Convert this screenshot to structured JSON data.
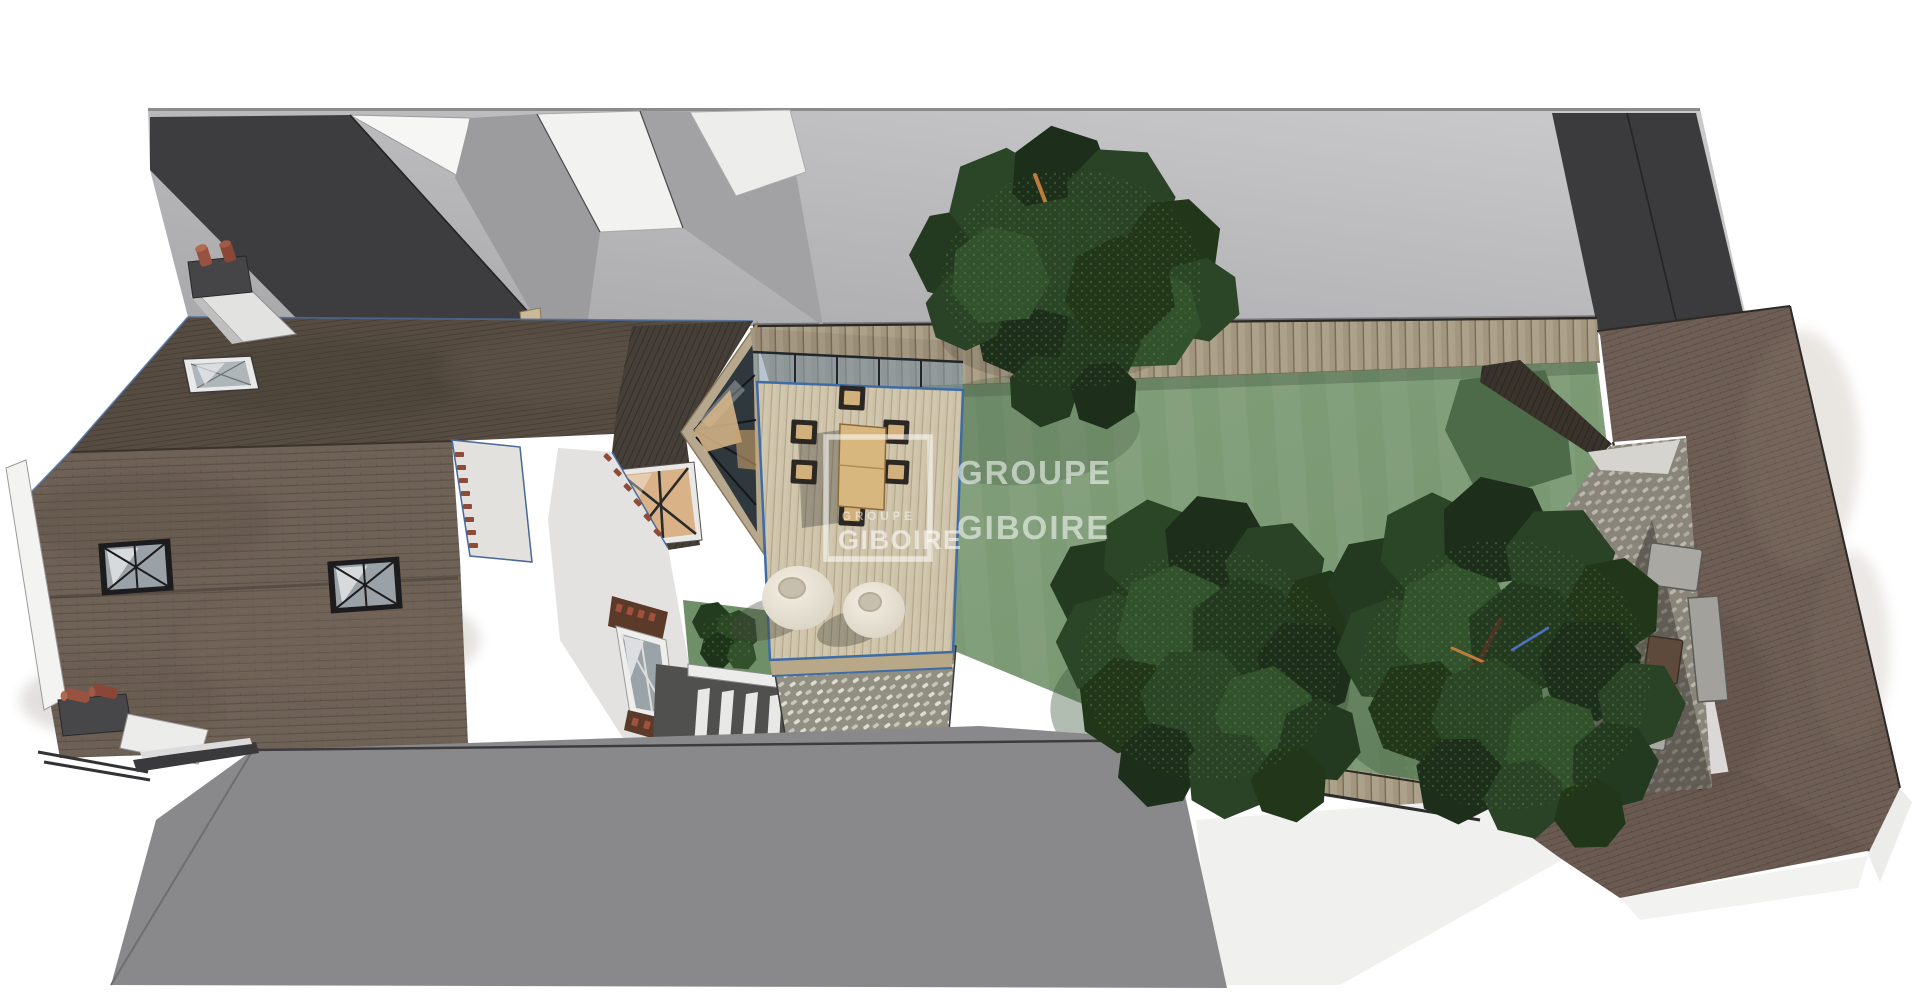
{
  "watermark": {
    "brand_line1": "GROUPE",
    "brand_line2": "GIBOIRE",
    "logo_text_small": "GROUPE",
    "logo_text_large": "GIBOIRE"
  },
  "colors": {
    "background": "#ffffff",
    "ground": "#b5b4b6",
    "building_dark": "#3d3d3f",
    "building_gray": "#9c9c9e",
    "building_white": "#f5f5f4",
    "roof_front": "#6e6156",
    "roof_back": "#564c42",
    "roof_right": "#6e5e55",
    "wall_dark": "#3b3b3d",
    "fence_wood": "#a3967e",
    "lawn": "#7e9c77",
    "foliage": "#243a20",
    "deck_wood": "#cec3a9",
    "wall_white": "#f1efec",
    "terracotta": "#8d4b38",
    "pebble_path": "#918e82",
    "neighbor_roof": "#8f8f91",
    "bay_glass": "#2e383d",
    "canopy_glass": "#7d96aa",
    "furniture_tan": "#d8b77e",
    "pouf_cream": "#e6e0d2",
    "watermark_white": "#ffffff"
  },
  "scene": {
    "description_objects": [
      {
        "id": "main-house",
        "label": "brown shingled house roof with roof windows and chimneys"
      },
      {
        "id": "extension",
        "label": "glazed bay extension with wooden deck"
      },
      {
        "id": "garden",
        "label": "lawn with large trees"
      },
      {
        "id": "right-building",
        "label": "rear building with stone patio"
      },
      {
        "id": "neighbors",
        "label": "grey neighbouring volumes"
      }
    ]
  }
}
